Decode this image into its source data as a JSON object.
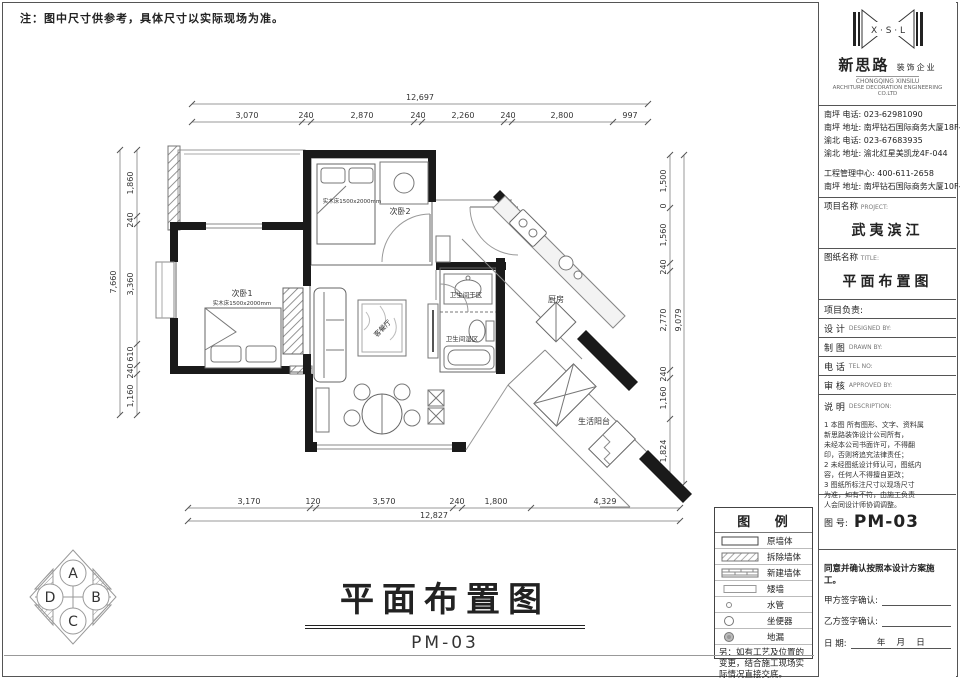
{
  "sheet": {
    "note": "注：图中尺寸供参考，具体尺寸以实际现场为准。",
    "title": "平面布置图",
    "title_code": "PM-03"
  },
  "compass": {
    "top": "A",
    "right": "B",
    "bottom": "C",
    "left": "D"
  },
  "plan": {
    "rooms": {
      "bedroom1": "次卧1",
      "bedroom1_note": "实木床1500x2000mm",
      "bedroom2": "次卧2",
      "bedroom2_note": "实木床1500x2000mm",
      "living": "客餐厅",
      "bath_dry": "卫生间干区",
      "bath_wet": "卫生间湿区",
      "kitchen": "厨房",
      "balcony": "生活阳台"
    },
    "dims": {
      "top": {
        "overall": "12,697",
        "segments": [
          "3,070",
          "240",
          "2,870",
          "240",
          "2,260",
          "240",
          "2,800",
          "997"
        ]
      },
      "bottom": {
        "overall": "12,827",
        "segments": [
          "3,170",
          "120",
          "3,570",
          "240",
          "1,800",
          "4,329"
        ]
      },
      "left": {
        "overall": "7,660",
        "segments": [
          "1,860",
          "240",
          "3,360",
          "610",
          "240",
          "1,160"
        ]
      },
      "right": {
        "overall": "9,079",
        "segments": [
          "1,500",
          "0",
          "1,560",
          "240",
          "2,770",
          "240",
          "1,160",
          "1,824"
        ]
      }
    }
  },
  "legend": {
    "title": "图  例",
    "items": [
      {
        "label": "原墙体"
      },
      {
        "label": "拆除墙体"
      },
      {
        "label": "新建墙体"
      },
      {
        "label": "矮墙"
      },
      {
        "label": "水管"
      },
      {
        "label": "坐便器"
      },
      {
        "label": "地漏"
      }
    ],
    "note": "另：如有工艺及位置的变更，结合施工现场实际情况直接交底。"
  },
  "titleblock": {
    "logo_initials": "X · S · L",
    "brand_cn": "新思路",
    "brand_suffix": "装饰企业",
    "brand_en1": "CHONGQING XINSILU",
    "brand_en2": "ARCHITURE DECORATION ENGINEERING CO.LTD",
    "contacts": [
      "南坪  电话: 023-62981090",
      "南坪  地址: 南坪钻石国际商务大厦18F-3",
      "渝北  电话: 023-67683935",
      "渝北  地址: 渝北红星美凯龙4F-044",
      "工程管理中心: 400-611-2658",
      "南坪  地址: 南坪钻石国际商务大厦10F-1"
    ],
    "project_label": "项目名称",
    "project_label_en": "PROJECT:",
    "project_name": "武夷滨江",
    "sheet_label": "图纸名称",
    "sheet_label_en": "TITLE:",
    "sheet_name": "平面布置图",
    "lead_label": "项目负责:",
    "rows": [
      {
        "cn": "设  计",
        "en": "DESIGNED BY:"
      },
      {
        "cn": "制  图",
        "en": "DRAWN BY:"
      },
      {
        "cn": "电  话",
        "en": "TEL NO:"
      },
      {
        "cn": "审  核",
        "en": "APPROVED BY:"
      }
    ],
    "desc_cn": "说  明",
    "desc_en": "DESCRIPTION:",
    "desc_lines": [
      "1 本图 所有图形、文字、资料属",
      "   新思路装饰设计公司所有，",
      "   未经本公司书面许可，不得翻",
      "   印，否则将追究法律责任；",
      "2 未经图纸设计师认可，图纸内",
      "   容，任何人不得擅自更改；",
      "3 图纸所标注尺寸以现场尺寸",
      "   为准，如有不符，由施工负责",
      "   人会同设计师协调调整。"
    ],
    "fig_label": "图 号:",
    "fig_no": "PM-03",
    "confirm": "同意并确认按照本设计方案施工。",
    "sign_a": "甲方签字确认:",
    "sign_b": "乙方签字确认:",
    "date_label": "日      期:",
    "date_value": "年　 月　 日"
  }
}
